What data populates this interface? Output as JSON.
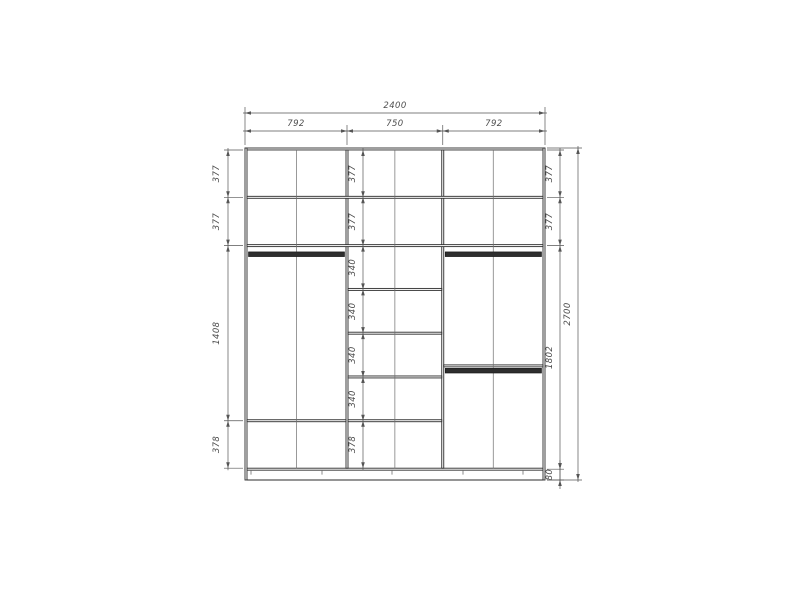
{
  "drawing": {
    "type": "wardrobe-interior-elevation",
    "units": "mm",
    "background": "#ffffff",
    "colors": {
      "carcass": "#2b2b2b",
      "panel_fill": "#ffffff",
      "thin_line": "#6e6e6e",
      "dim_line": "#555555",
      "dim_text": "#4d4d4d",
      "rod": "#2e2e2e",
      "rod_edge": "#141414"
    },
    "cabinet": {
      "width": 2400,
      "height": 2700,
      "panel_thickness": 16,
      "base_height": 80,
      "sections": [
        {
          "width": 792
        },
        {
          "width": 750
        },
        {
          "width": 792
        }
      ],
      "full_shelves_y": [
        393,
        786
      ],
      "middle_shelves_y": [
        1142,
        1498,
        1854,
        2210
      ],
      "left_shelf_y": 2210,
      "right_shelf_y": 1764,
      "rods": [
        {
          "section": "left",
          "y": 845
        },
        {
          "section": "right",
          "y": 845
        },
        {
          "section": "right",
          "y": 1792
        }
      ],
      "center_lines_x": [
        412,
        1199,
        1986
      ],
      "feet_x": [
        48,
        616,
        1176,
        1744,
        2224
      ]
    },
    "viewport": {
      "x": 245,
      "y": 148,
      "w": 300,
      "h": 332
    },
    "dimensions": {
      "top_overall": {
        "label": "2400",
        "boundaries_mm": [
          0,
          2400
        ]
      },
      "top_sections": {
        "labels": [
          "792",
          "750",
          "792"
        ],
        "boundaries_mm": [
          0,
          816,
          1582,
          2400
        ]
      },
      "left_chain": {
        "labels": [
          "377",
          "377",
          "1408",
          "378"
        ],
        "boundaries_mm": [
          16,
          401,
          794,
          2218,
          2604
        ]
      },
      "middle_chain": {
        "labels": [
          "377",
          "377",
          "340",
          "340",
          "340",
          "340",
          "378"
        ],
        "boundaries_mm": [
          16,
          401,
          794,
          1150,
          1506,
          1862,
          2218,
          2604
        ]
      },
      "right_chain": {
        "labels": [
          "377",
          "377",
          "1802",
          "80"
        ],
        "boundaries_mm": [
          16,
          401,
          794,
          2612,
          2700
        ]
      },
      "right_overall": {
        "label": "2700",
        "boundaries_mm": [
          0,
          2700
        ]
      }
    }
  }
}
